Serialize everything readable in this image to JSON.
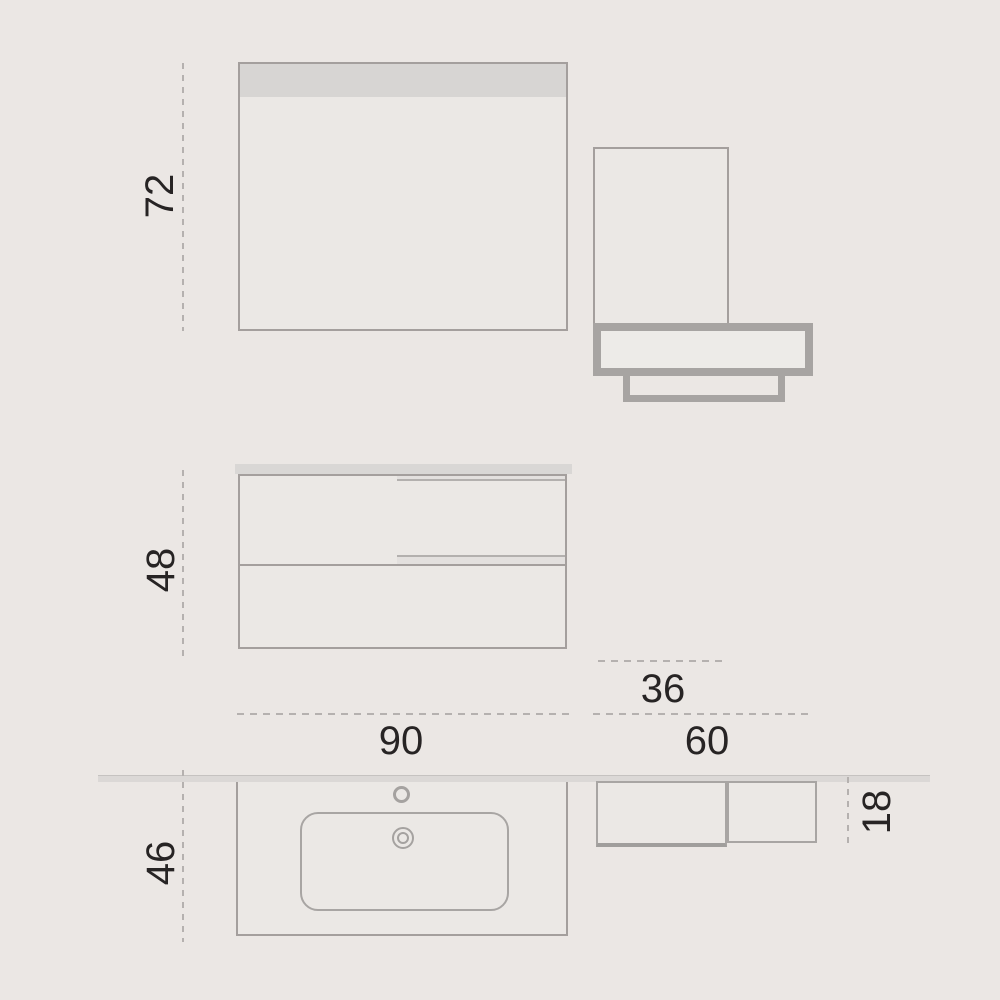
{
  "diagram": {
    "type": "furniture-dimension-drawing",
    "subject": "bathroom vanity set: mirror, tall column with wall shelf, two-drawer vanity cabinet, and countertop washbasin top view",
    "labels": {
      "mirror_height": "72",
      "vanity_height": "48",
      "counter_depth": "46",
      "vanity_width": "90",
      "column_width": "36",
      "shelf_width": "60",
      "shelf_depth": "18"
    },
    "colors": {
      "background": "#ebe7e4",
      "thin_outline": "#a49f9d",
      "thick_outline": "#a7a4a2",
      "panel_fill": "#ebe8e5",
      "mirror_band": "#d7d5d3",
      "counter_strip": "#dbd8d6",
      "dashed_line": "#b5b1af",
      "text": "#272424"
    }
  }
}
